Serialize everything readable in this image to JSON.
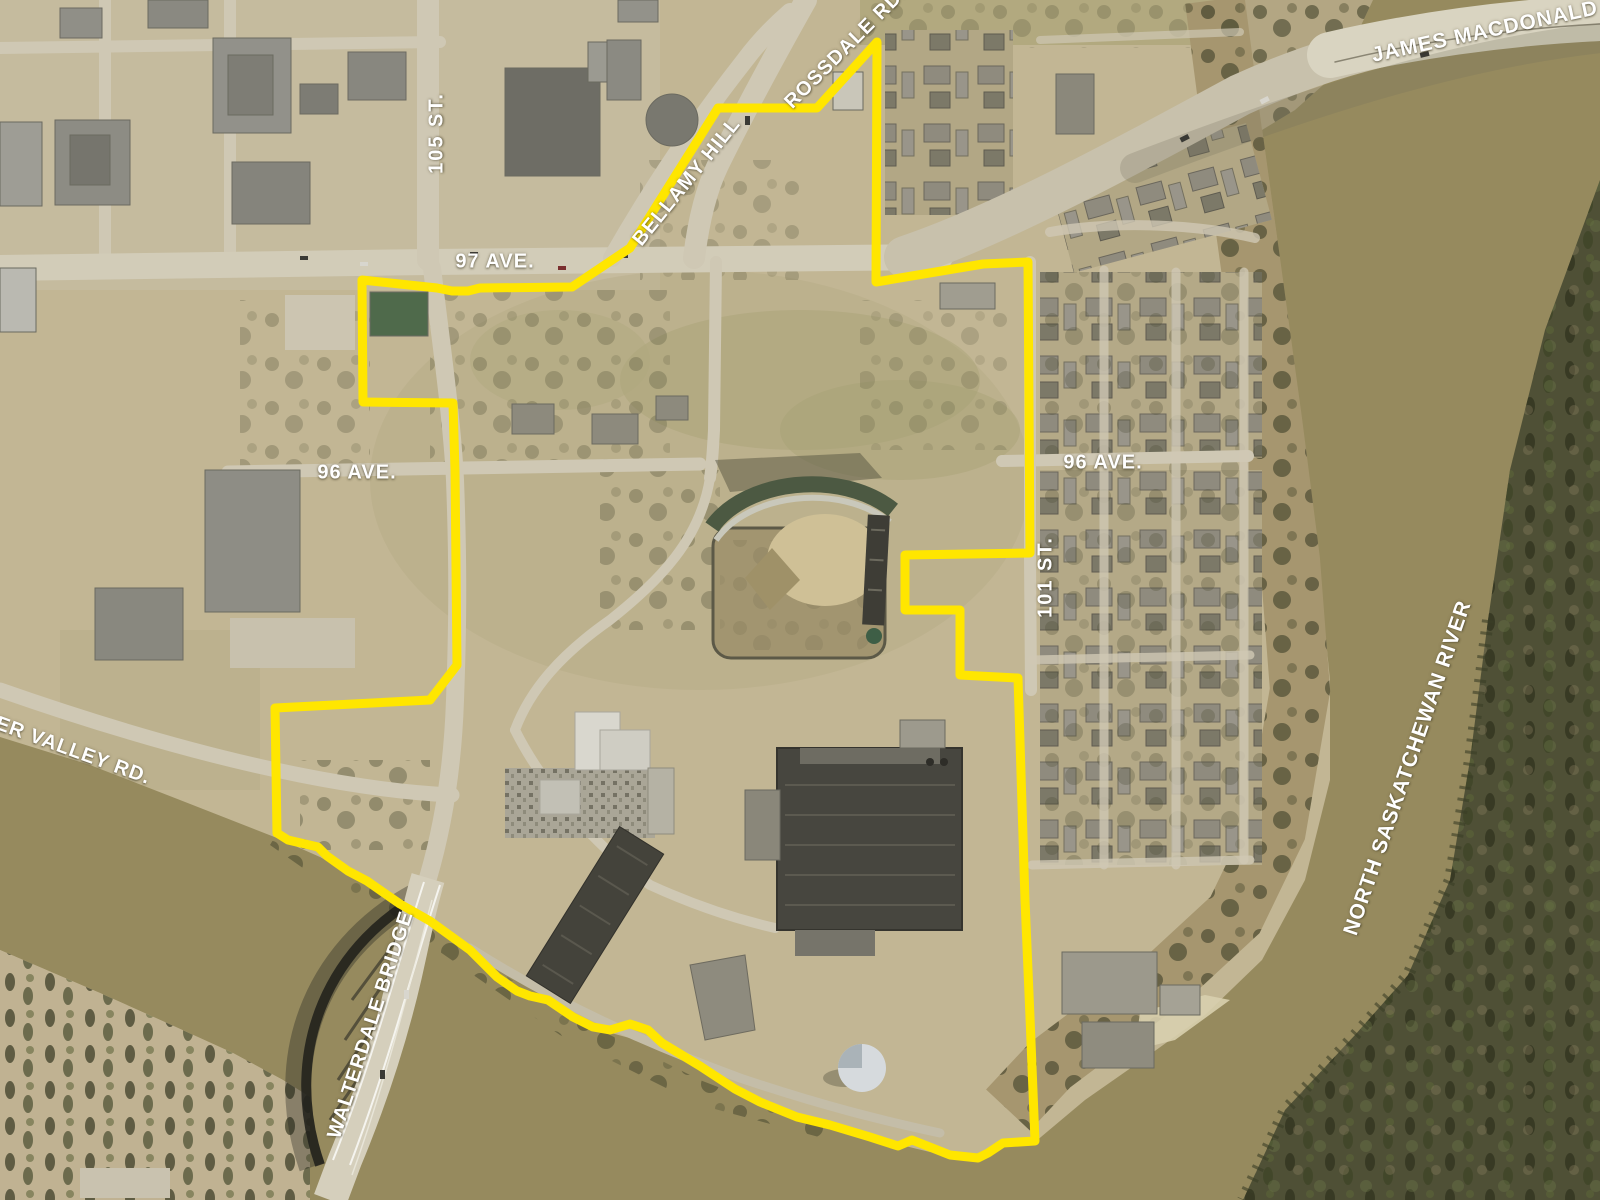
{
  "labels": {
    "james_macdonald_bridge": "JAMES MACDONALD BRIDGE",
    "rossdale_rd": "ROSSDALE RD.",
    "bellamy_hill": "BELLAMY HILL",
    "st_105": "105 ST.",
    "ave_97": "97 AVE.",
    "ave_96_west": "96 AVE.",
    "ave_96_east": "96 AVE.",
    "st_101": "101 ST.",
    "north_saskatchewan_river": "NORTH SASKATCHEWAN RIVER",
    "river_valley_rd": "RIVER VALLEY RD.",
    "walterdale_bridge": "WALTERDALE BRIDGE"
  },
  "colors": {
    "boundary": "#FFE600",
    "water": "#968A5E",
    "land": "#C2B694",
    "forest": "#4F5036",
    "label_text": "#FFFFFF"
  }
}
